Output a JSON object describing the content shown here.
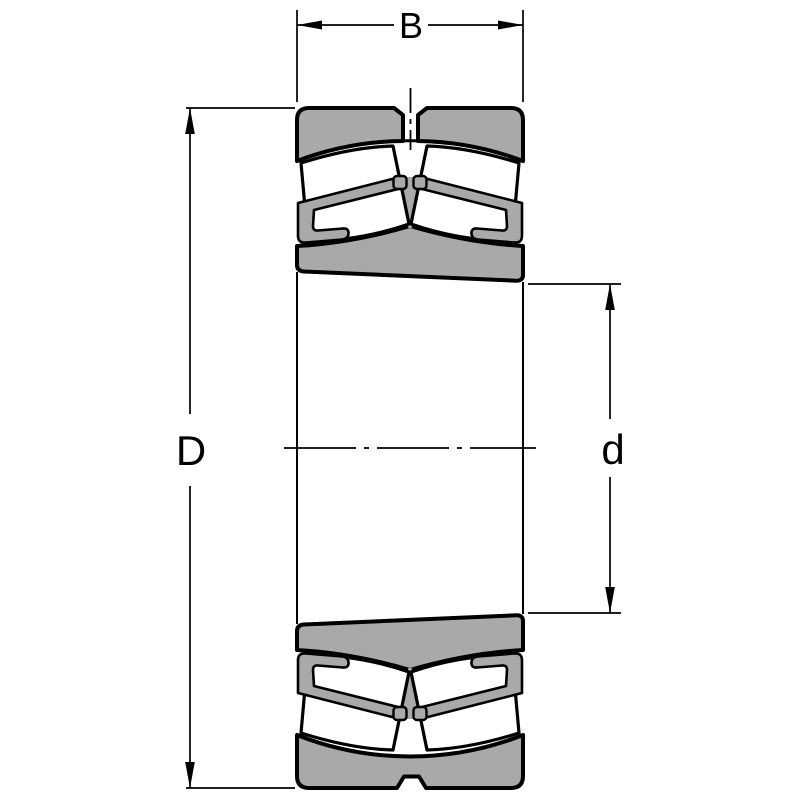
{
  "drawing": {
    "title": "spherical-roller-bearing-cross-section",
    "labels": {
      "width": "B",
      "outer_diameter": "D",
      "bore_diameter": "d"
    },
    "colors": {
      "fill_gray": "#a9a9a9",
      "outline": "#000000",
      "background": "#ffffff"
    }
  }
}
